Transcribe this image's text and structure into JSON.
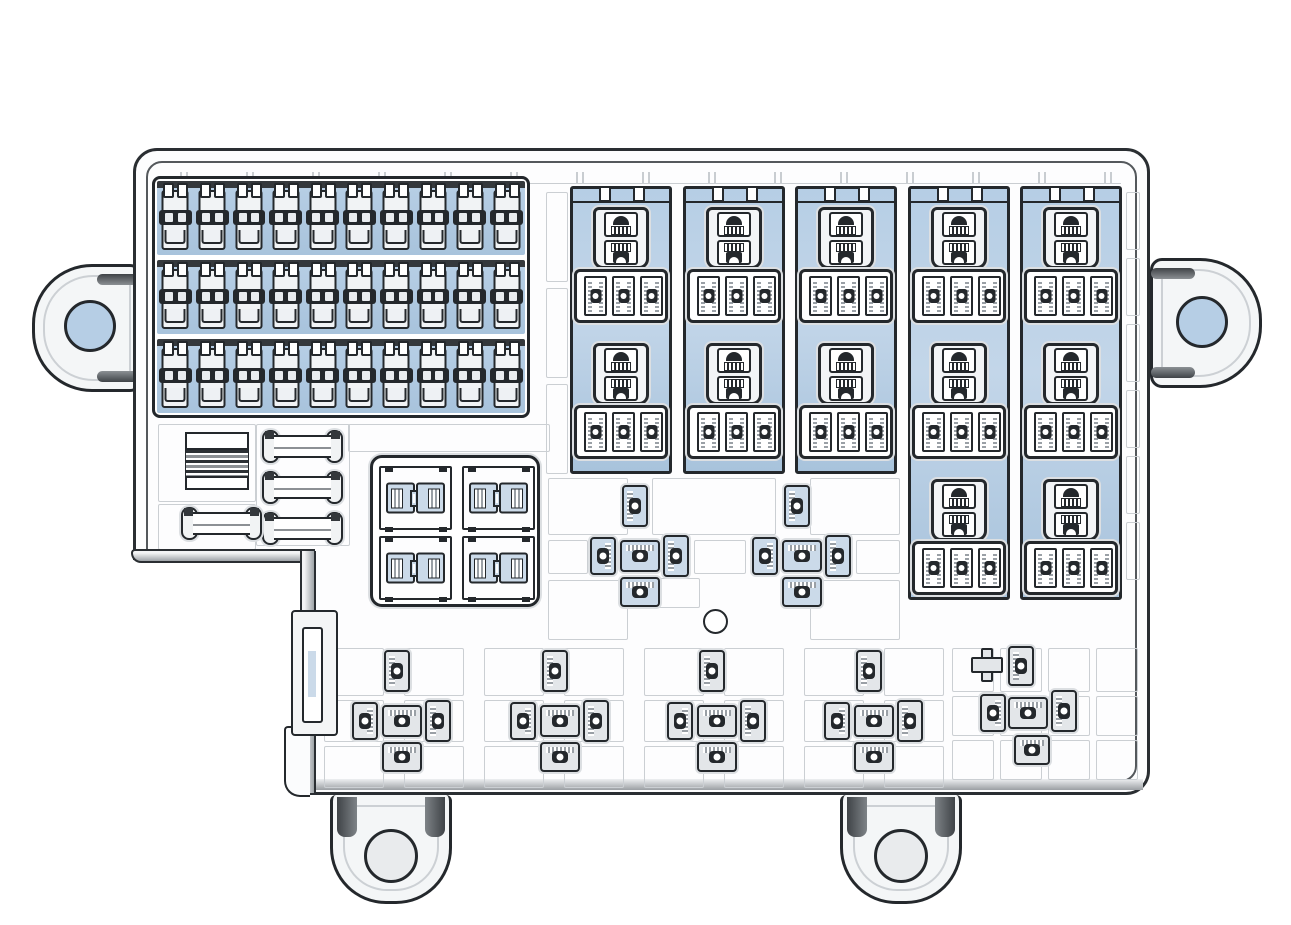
{
  "meta": {
    "description": "Automotive engine-bay fuse and relay junction box, top view technical line drawing with blue highlighted fuse and relay cavities",
    "canvas": {
      "width": 1291,
      "height": 925
    }
  },
  "colors": {
    "ink": "#24282c",
    "cavity_blue": "#b6cee5",
    "cavity_blue_dark": "#a8c3dc",
    "terminal_blue": "#cbdae9",
    "terminal_gray": "#e3e6e9",
    "grid_gray": "#cbcfd3",
    "hatch_gray": "#9aa0a6",
    "housing_fill": "#fdfdfe",
    "shade_dark": "#3f4347"
  },
  "inventory": {
    "mini_fuse_bank": {
      "rows": 3,
      "cols": 10,
      "total_fuses": 30
    },
    "relay_bank": {
      "columns": 5,
      "sockets_per_column": [
        2,
        2,
        2,
        3,
        3
      ],
      "total_sockets": 12,
      "terminals_per_socket": 3
    },
    "jcase_block": {
      "cavities": 4,
      "connectors_per_cavity": 2
    },
    "fusible_link_holders": 4,
    "striped_label_block": 1,
    "terminal_clusters_mid": 2,
    "terminal_clusters_bottom": 4,
    "terminal_cluster_right_bottom": 1,
    "mounting_tabs_side": 2,
    "mounting_feet_bottom": 2,
    "center_hole": 1,
    "side_connector_bracket": 1
  },
  "layout": {
    "fuse_bank": {
      "x": 152,
      "y": 176,
      "w": 378,
      "h": 242,
      "rows": 3,
      "cols": 10
    },
    "relay_bank": {
      "columns": [
        {
          "x": 570,
          "h": 288,
          "sockets": 2
        },
        {
          "x": 683,
          "h": 288,
          "sockets": 2
        },
        {
          "x": 795,
          "h": 288,
          "sockets": 2
        },
        {
          "x": 908,
          "h": 414,
          "sockets": 3
        },
        {
          "x": 1020,
          "h": 414,
          "sockets": 3
        }
      ],
      "socket_top": 18,
      "socket_pitch": 136
    },
    "jcase": {
      "x": 370,
      "y": 455,
      "w": 170,
      "h": 152,
      "quads": [
        {
          "x": 6,
          "y": 8
        },
        {
          "x": 89,
          "y": 8
        },
        {
          "x": 6,
          "y": 78
        },
        {
          "x": 89,
          "y": 78
        }
      ]
    },
    "links": {
      "holders": [
        {
          "x": 262,
          "y": 429
        },
        {
          "x": 262,
          "y": 470
        },
        {
          "x": 262,
          "y": 511
        },
        {
          "x": 181,
          "y": 506
        }
      ]
    },
    "clusters": {
      "mid_blue": [
        {
          "x": 590,
          "y": 485
        },
        {
          "x": 752,
          "y": 485
        }
      ],
      "bottom_gray": [
        {
          "x": 352,
          "y": 650
        },
        {
          "x": 510,
          "y": 650
        },
        {
          "x": 667,
          "y": 650
        },
        {
          "x": 824,
          "y": 650
        }
      ],
      "right_bottom_terms": [
        {
          "dir": "right",
          "x": 1008,
          "y": 646,
          "w": 26,
          "h": 40
        },
        {
          "dir": "left",
          "x": 980,
          "y": 694,
          "w": 26,
          "h": 38
        },
        {
          "dir": "down",
          "x": 1008,
          "y": 697,
          "w": 40,
          "h": 32
        },
        {
          "dir": "right",
          "x": 1051,
          "y": 690,
          "w": 26,
          "h": 42
        },
        {
          "dir": "down",
          "x": 1014,
          "y": 735,
          "w": 36,
          "h": 30
        }
      ]
    },
    "grid_rows": [
      {
        "x": 546,
        "y": 192,
        "w": 20,
        "h": 88,
        "count": 3,
        "dy": 96
      },
      {
        "x": 1126,
        "y": 192,
        "w": 12,
        "h": 56,
        "count": 6,
        "dy": 66
      },
      {
        "x": 158,
        "y": 424,
        "w": 96,
        "h": 76,
        "count": 1
      },
      {
        "x": 158,
        "y": 504,
        "w": 96,
        "h": 44,
        "count": 1
      },
      {
        "x": 256,
        "y": 424,
        "w": 92,
        "h": 120,
        "count": 1
      },
      {
        "x": 348,
        "y": 424,
        "w": 200,
        "h": 26,
        "count": 1
      },
      {
        "x": 548,
        "y": 478,
        "w": 78,
        "h": 55,
        "count": 1
      },
      {
        "x": 652,
        "y": 478,
        "w": 122,
        "h": 55,
        "count": 1
      },
      {
        "x": 810,
        "y": 478,
        "w": 88,
        "h": 55,
        "count": 1
      },
      {
        "x": 548,
        "y": 540,
        "w": 38,
        "h": 32,
        "count": 1
      },
      {
        "x": 694,
        "y": 540,
        "w": 50,
        "h": 32,
        "count": 1
      },
      {
        "x": 856,
        "y": 540,
        "w": 42,
        "h": 32,
        "count": 1
      },
      {
        "x": 548,
        "y": 580,
        "w": 78,
        "h": 58,
        "count": 1
      },
      {
        "x": 656,
        "y": 578,
        "w": 42,
        "h": 28,
        "count": 1
      },
      {
        "x": 810,
        "y": 580,
        "w": 88,
        "h": 58,
        "count": 1
      },
      {
        "x": 324,
        "y": 648,
        "w": 58,
        "h": 46,
        "count": 8,
        "dx": 80
      },
      {
        "x": 324,
        "y": 700,
        "w": 58,
        "h": 40,
        "count": 8,
        "dx": 80
      },
      {
        "x": 324,
        "y": 746,
        "w": 58,
        "h": 40,
        "count": 8,
        "dx": 80
      },
      {
        "x": 952,
        "y": 648,
        "w": 40,
        "h": 42,
        "count": 4,
        "dx": 48
      },
      {
        "x": 952,
        "y": 696,
        "w": 40,
        "h": 38,
        "count": 4,
        "dx": 48
      },
      {
        "x": 952,
        "y": 740,
        "w": 40,
        "h": 38,
        "count": 4,
        "dx": 48
      }
    ],
    "hole": {
      "cx": 714,
      "cy": 620,
      "r": 11
    },
    "mounts": {
      "left_tab_hole": {
        "cx": 85,
        "cy": 322,
        "r": 23,
        "fill": "blue"
      },
      "right_tab_hole": {
        "cx": 1198,
        "cy": 321,
        "r": 23,
        "fill": "blue"
      },
      "feet": [
        {
          "x": 330
        },
        {
          "x": 840
        }
      ]
    }
  }
}
